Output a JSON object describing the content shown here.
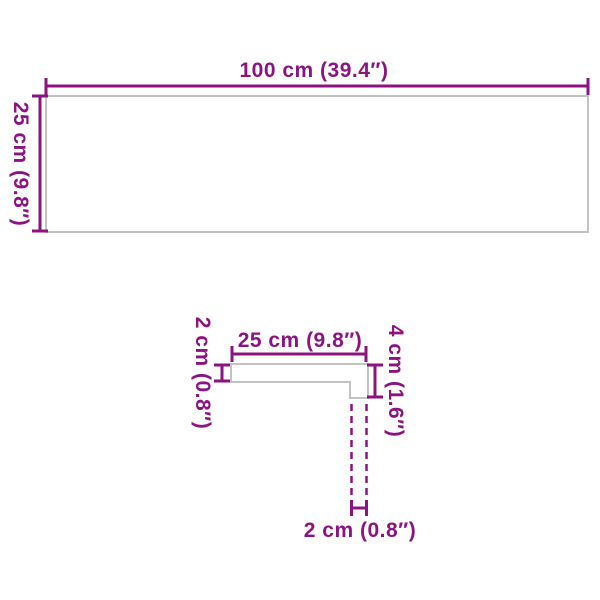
{
  "colors": {
    "accent": "#8B1480",
    "outline": "#c3c3c3",
    "background": "#ffffff"
  },
  "figures": {
    "board_front": {
      "width_label": "100 cm (39.4″)",
      "height_label": "25 cm (9.8″)"
    },
    "profile_section": {
      "top_width_label": "25 cm (9.8″)",
      "left_thickness_label": "2 cm (0.8″)",
      "right_height_label": "4 cm (1.6″)",
      "bottom_thickness_label": "2 cm (0.8″)"
    }
  }
}
